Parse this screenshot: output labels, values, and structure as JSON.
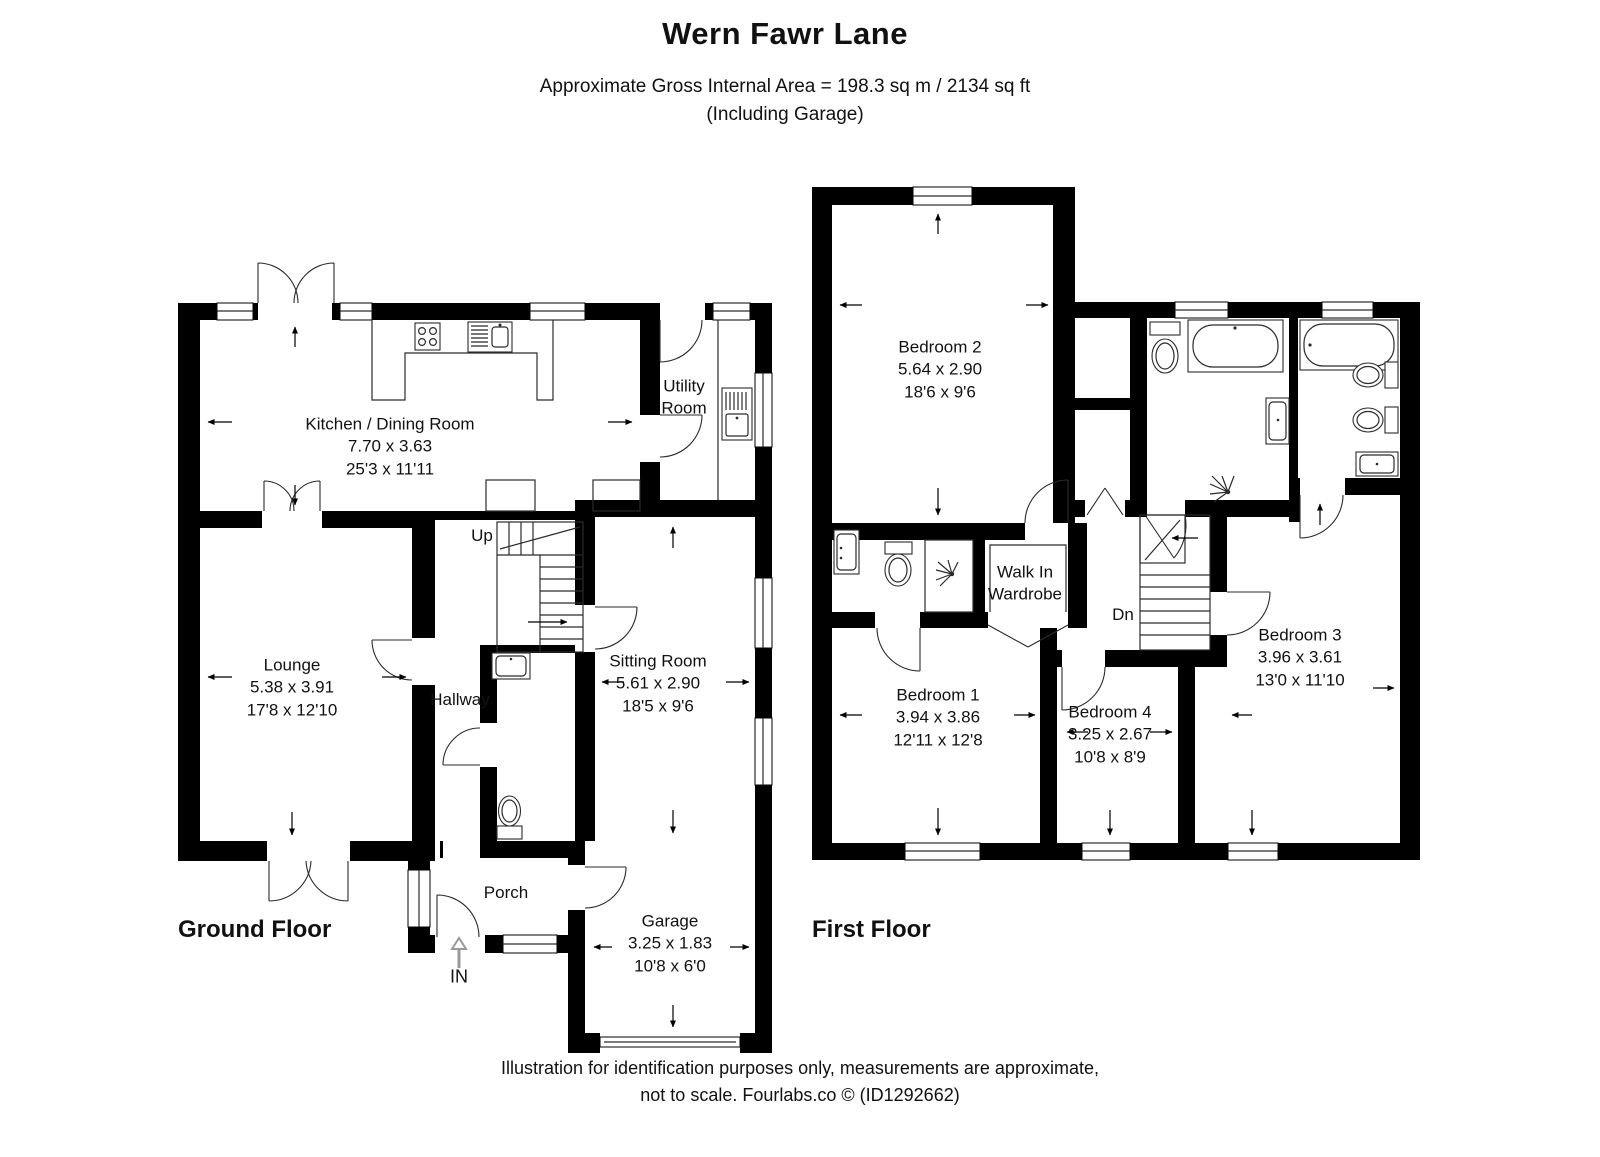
{
  "header": {
    "title": "Wern Fawr Lane",
    "area_line": "Approximate Gross Internal Area = 198.3 sq m / 2134 sq ft",
    "garage_line": "(Including Garage)"
  },
  "ground_floor": {
    "label": "Ground Floor",
    "stairs_label": "Up",
    "entrance_label": "IN",
    "rooms": {
      "kitchen": {
        "name": "Kitchen / Dining Room",
        "metric": "7.70 x 3.63",
        "imperial": "25'3 x 11'11"
      },
      "utility": {
        "line1": "Utility",
        "line2": "Room"
      },
      "lounge": {
        "name": "Lounge",
        "metric": "5.38 x 3.91",
        "imperial": "17'8 x 12'10"
      },
      "hallway": {
        "name": "Hallway"
      },
      "sitting": {
        "name": "Sitting Room",
        "metric": "5.61 x 2.90",
        "imperial": "18'5 x 9'6"
      },
      "porch": {
        "name": "Porch"
      },
      "garage": {
        "name": "Garage",
        "metric": "3.25 x 1.83",
        "imperial": "10'8 x 6'0"
      }
    }
  },
  "first_floor": {
    "label": "First Floor",
    "stairs_label": "Dn",
    "rooms": {
      "bedroom2": {
        "name": "Bedroom 2",
        "metric": "5.64 x 2.90",
        "imperial": "18'6 x 9'6"
      },
      "bedroom1": {
        "name": "Bedroom 1",
        "metric": "3.94 x 3.86",
        "imperial": "12'11 x 12'8"
      },
      "bedroom4": {
        "name": "Bedroom 4",
        "metric": "3.25 x 2.67",
        "imperial": "10'8 x 8'9"
      },
      "bedroom3": {
        "name": "Bedroom 3",
        "metric": "3.96 x 3.61",
        "imperial": "13'0 x 11'10"
      },
      "wardrobe": {
        "line1": "Walk In",
        "line2": "Wardrobe"
      }
    }
  },
  "footer": {
    "line1": "Illustration for identification purposes only, measurements are approximate,",
    "line2": "not to scale. Fourlabs.co © (ID1292662)"
  },
  "colors": {
    "wall": "#000000",
    "text": "#111111",
    "entrance_arrow": "#9a9a9a"
  }
}
